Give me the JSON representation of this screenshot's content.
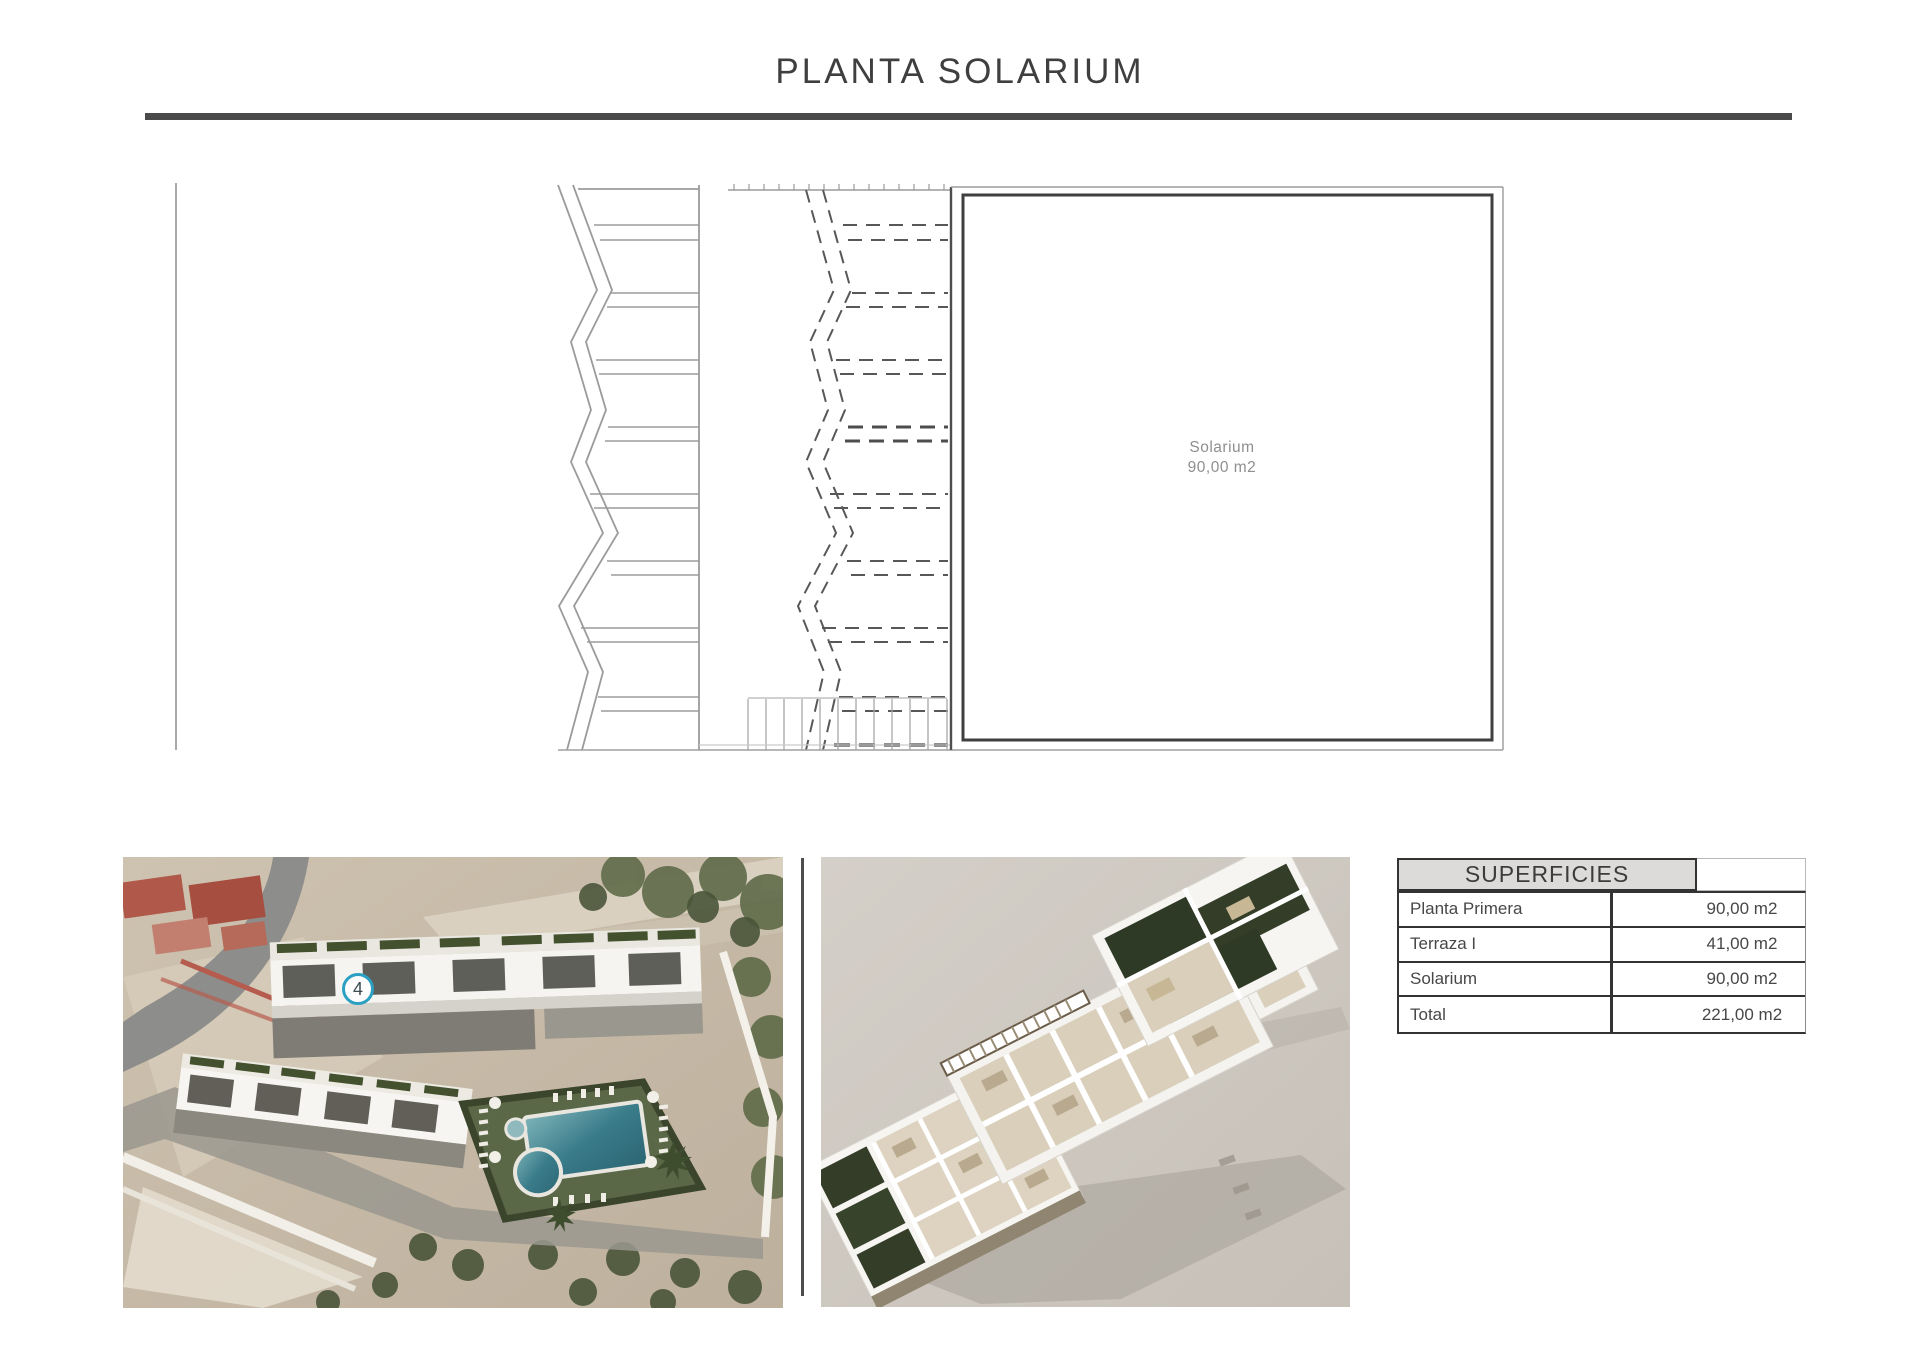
{
  "page": {
    "title": "PLANTA SOLARIUM"
  },
  "plan": {
    "room_label": "Solarium",
    "room_area": "90,00 m2"
  },
  "aerial": {
    "unit_badge": "4"
  },
  "table": {
    "header": "SUPERFICIES",
    "rows": [
      {
        "label": "Planta Primera",
        "value": "90,00 m2"
      },
      {
        "label": "Terraza I",
        "value": "41,00 m2"
      },
      {
        "label": "Solarium",
        "value": "90,00 m2"
      },
      {
        "label": "Total",
        "value": "221,00 m2"
      }
    ]
  },
  "colors": {
    "accent_badge": "#2ba0c2",
    "rule_dark": "#4a4a4a",
    "table_border": "#333333",
    "table_header_bg": "#dcdbd9",
    "plan_light_line": "#9b9b9b",
    "plan_dark_line": "#3f3f3f",
    "pool_teal": "#2e6f7d",
    "iso_background": "#cdc7bf"
  }
}
